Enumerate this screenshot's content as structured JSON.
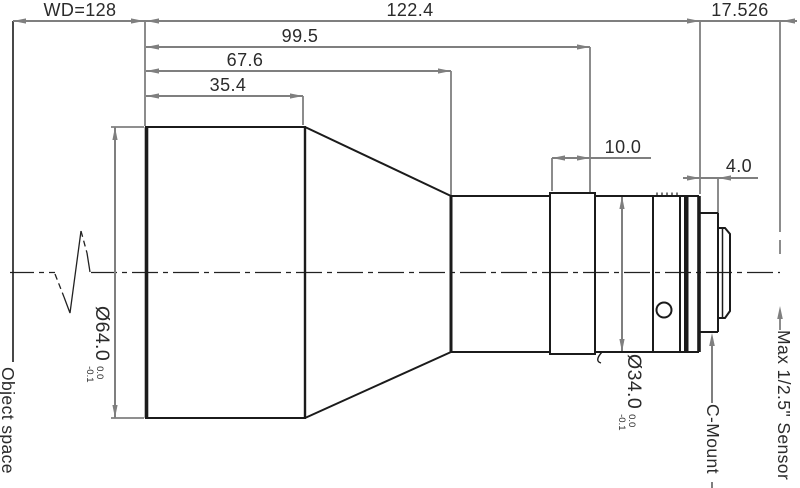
{
  "drawing": {
    "type": "lens mechanical outline drawing",
    "colors": {
      "body_line": "#1b1b1b",
      "dimension_line": "#7f7f7f",
      "text": "#2b2b2b",
      "background": "#ffffff"
    }
  },
  "dimensions": {
    "working_distance": "WD=128",
    "total_length": "122.4",
    "length_99_5": "99.5",
    "length_67_6": "67.6",
    "length_35_4": "35.4",
    "focus_ring_width": "10.0",
    "thread_length": "4.0",
    "flange_focal_distance": "17.526"
  },
  "diameters": {
    "front": {
      "value": "Ø64.0",
      "tol_upper": "0.0",
      "tol_lower": "-0.1"
    },
    "barrel": {
      "value": "Ø34.0",
      "tol_upper": "0.0",
      "tol_lower": "-0.1"
    }
  },
  "labels": {
    "object_space": "Object space",
    "c_mount": "C-Mount",
    "max_sensor": "Max 1/2.5\" Sensor"
  }
}
